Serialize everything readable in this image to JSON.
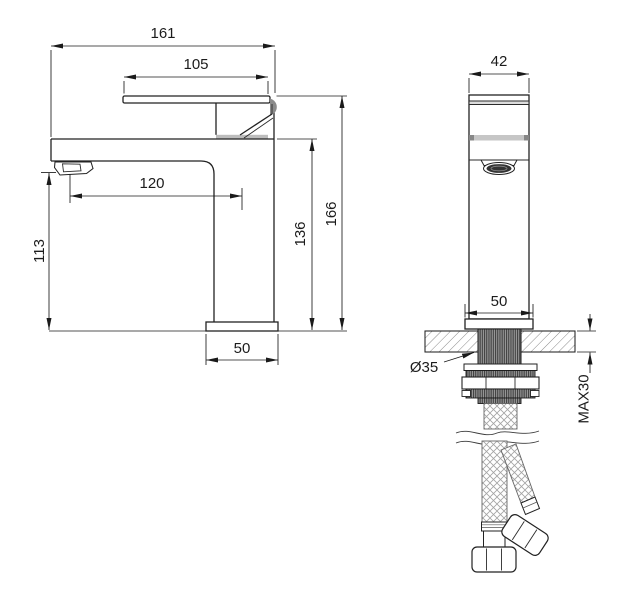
{
  "drawing": {
    "type": "faucet installation dimension drawing",
    "line_color": "#1c1c1c",
    "background": "#ffffff",
    "views": {
      "side": {
        "name": "side-view",
        "dims": {
          "total_width": "161",
          "handle_length": "105",
          "spout_reach": "120",
          "outlet_height": "113",
          "body_height": "136",
          "total_height": "166",
          "base_width": "50"
        }
      },
      "front": {
        "name": "front-view",
        "dims": {
          "body_width": "42",
          "base_width": "50",
          "shank_diameter": "Ø35",
          "max_deck_thickness": "MAX30"
        }
      }
    }
  }
}
